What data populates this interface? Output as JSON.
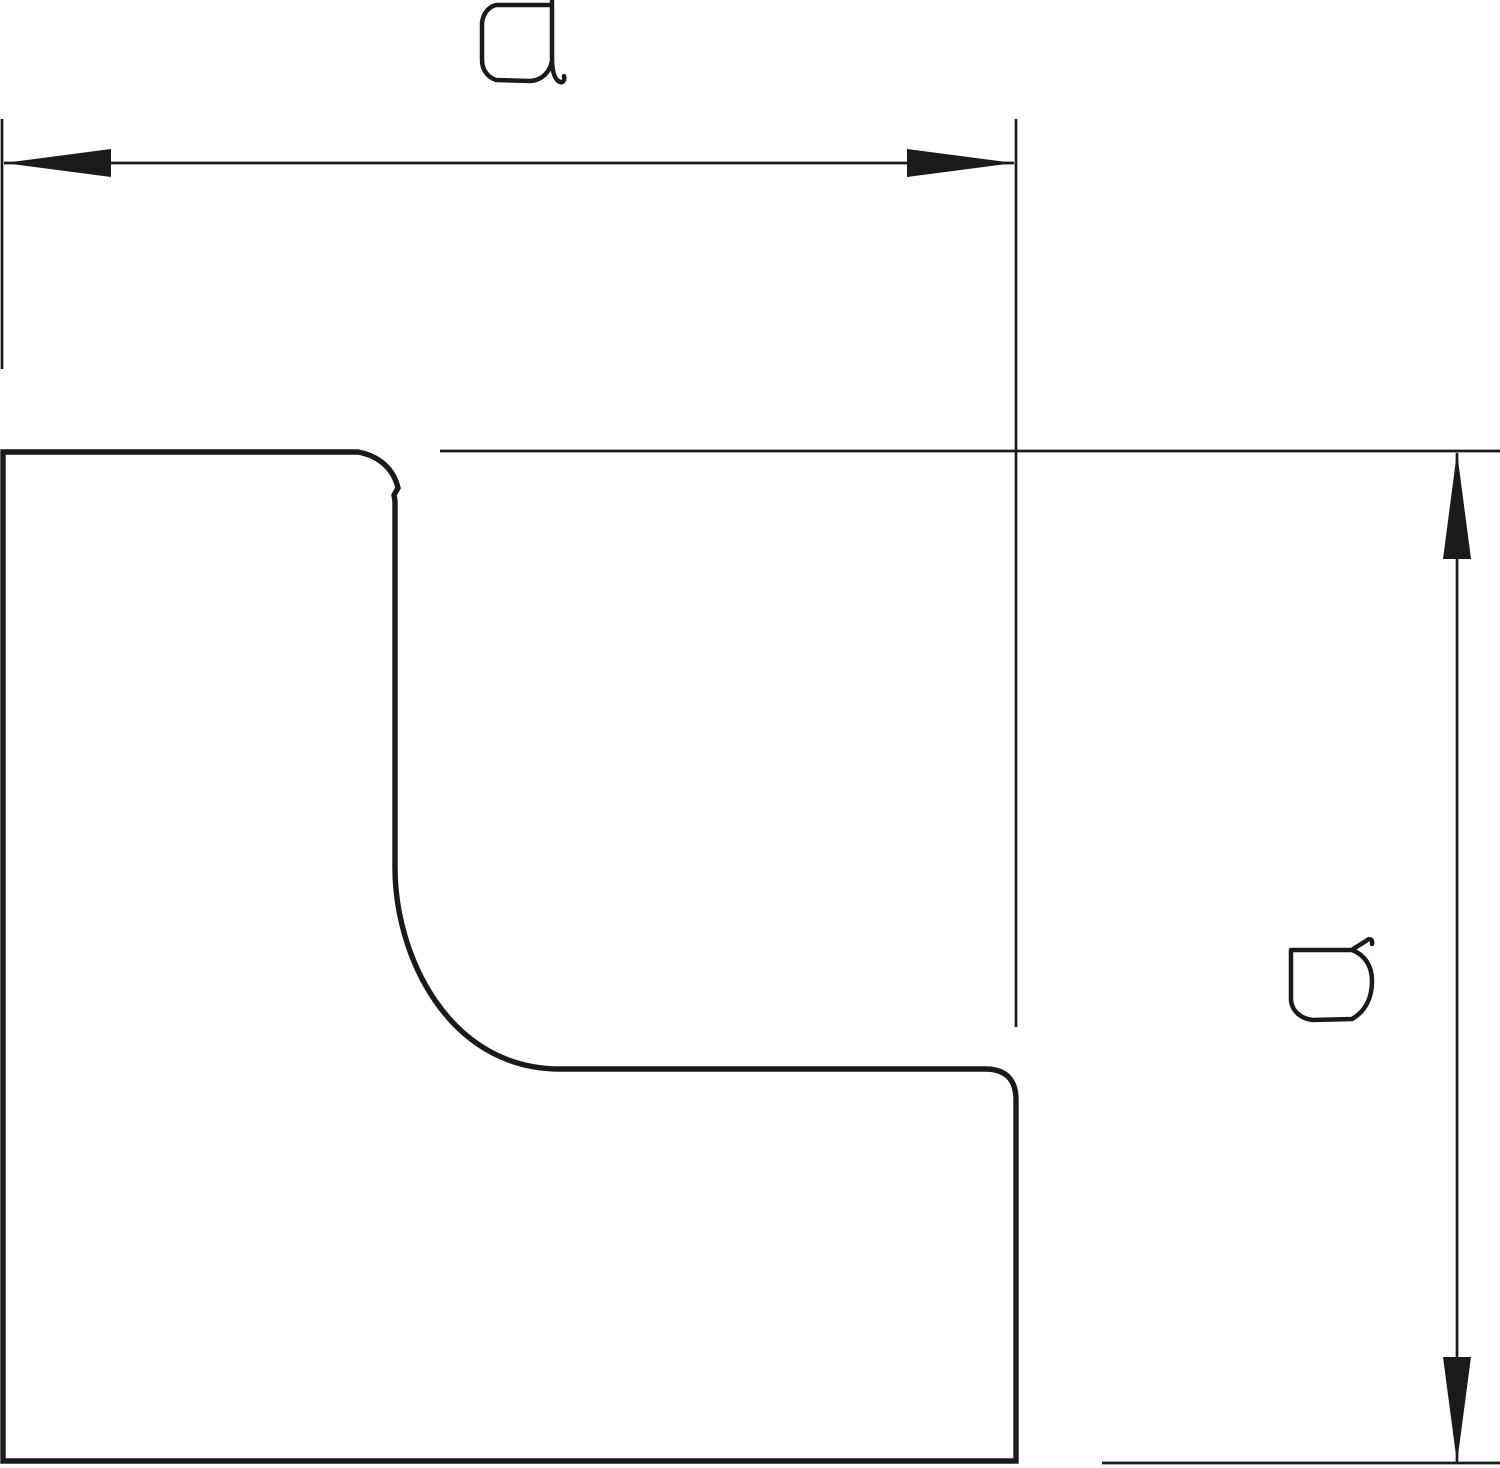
{
  "diagram": {
    "kind": "technical-dimension-drawing",
    "description": "Profile outline of an L-shaped corner piece with width and height dimension callouts",
    "colors": {
      "background": "#ffffff",
      "line": "#1a1a1a"
    },
    "dimensions": [
      {
        "label": "a",
        "orientation": "horizontal",
        "position": "top"
      },
      {
        "label": "b",
        "orientation": "vertical",
        "position": "right"
      }
    ]
  }
}
